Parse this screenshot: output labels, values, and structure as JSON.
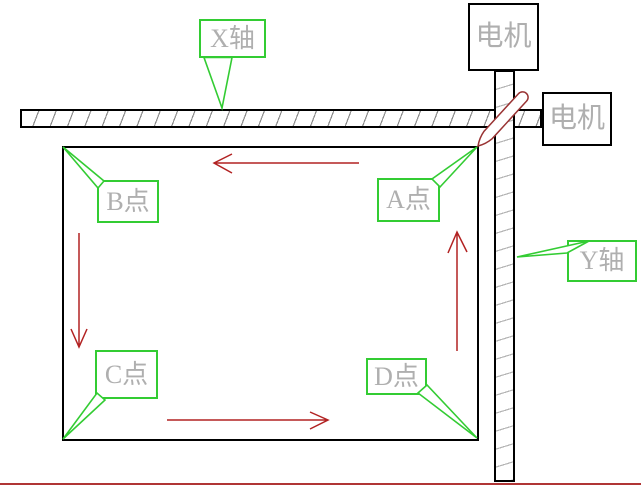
{
  "callouts": {
    "x_axis": {
      "label": "X轴"
    },
    "y_axis": {
      "label": "Y轴"
    },
    "point_a": {
      "label": "A点"
    },
    "point_b": {
      "label": "B点"
    },
    "point_c": {
      "label": "C点"
    },
    "point_d": {
      "label": "D点"
    }
  },
  "motors": {
    "top": {
      "label": "电机"
    },
    "right": {
      "label": "电机"
    }
  },
  "arrows": [
    {
      "name": "top-arrow",
      "direction": "left"
    },
    {
      "name": "left-arrow",
      "direction": "down"
    },
    {
      "name": "bottom-arrow",
      "direction": "right"
    },
    {
      "name": "right-arrow",
      "direction": "up"
    }
  ],
  "colors": {
    "callout_border": "#33cc33",
    "label_text": "#afafaf",
    "outline": "#000000",
    "arrow": "#b22222",
    "marker": "#993333",
    "ground_line": "#b03535",
    "hatch_x": "#8c8c8c",
    "hatch_y": "#b5b5b5"
  }
}
